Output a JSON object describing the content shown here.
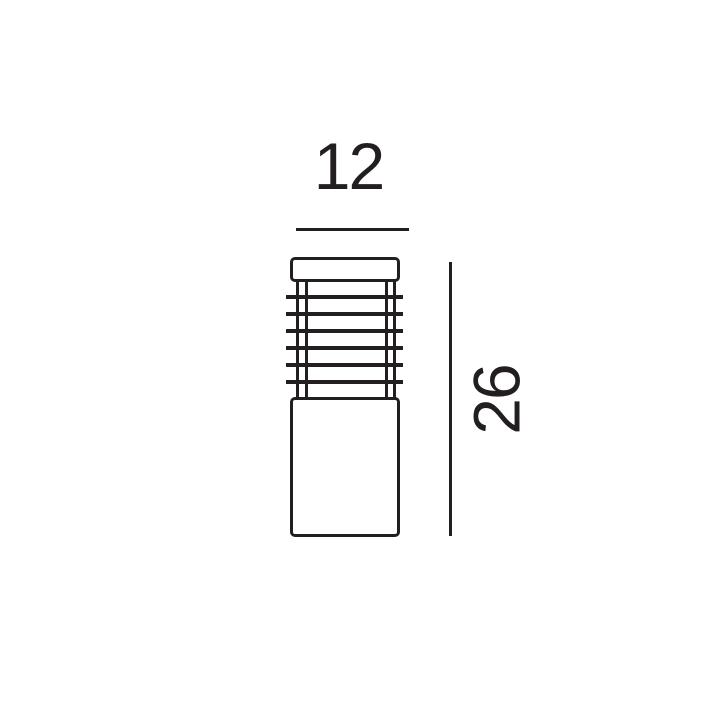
{
  "figure": {
    "subject": "bollard-light-technical-drawing",
    "ink_color": "#231f20",
    "background_color": "#ffffff",
    "width_dimension": {
      "label": "12"
    },
    "height_dimension": {
      "label": "26"
    },
    "grille": {
      "slat_count": 6,
      "rail_count": 4
    }
  }
}
